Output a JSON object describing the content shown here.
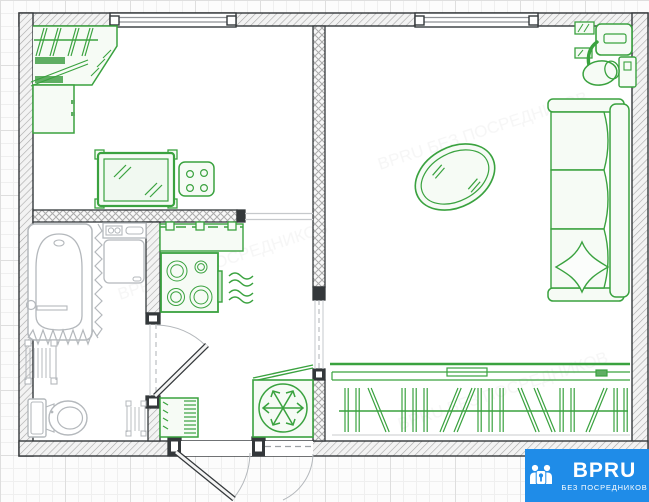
{
  "watermark": {
    "brand": "BPRU",
    "tagline": "БЕЗ ПОСРЕДНИКОВ",
    "ghost_text": "BPRU БЕЗ ПОСРЕДНИКОВ"
  },
  "colors": {
    "furniture_green": "#3aa23f",
    "furniture_fill": "#f6fbf5",
    "fixture_gray": "#b4b8bc",
    "wall_dark": "#34383b",
    "logo_blue": "#1f8ce8"
  },
  "floor_plan": {
    "rooms": [
      {
        "name": "bedroom",
        "position": "top-left",
        "furniture": [
          "corner-wardrobe-with-hangers",
          "shelves",
          "cabinet",
          "mirror-table",
          "four-burner-hob"
        ]
      },
      {
        "name": "kitchen-hallway",
        "position": "bottom-middle",
        "furniture": [
          "kitchen-counter",
          "stove-four-burners",
          "steam-vent",
          "refrigerator-snowflake",
          "shoe-cabinet"
        ]
      },
      {
        "name": "bathroom",
        "position": "bottom-left",
        "furniture": [
          "bathtub",
          "shower-curtain",
          "washing-machine",
          "radiator",
          "towel-ladder",
          "toilet",
          "rack"
        ]
      },
      {
        "name": "living-room",
        "position": "right",
        "furniture": [
          "desk-with-office-chair",
          "oval-coffee-table",
          "sofa-three-seat-with-pillow",
          "built-in-wardrobe-with-hangers"
        ]
      }
    ],
    "openings": [
      "window-top-left",
      "window-top-right",
      "entrance-door-bottom",
      "bathroom-door",
      "kitchen-living-room-opening",
      "bedroom-kitchen-opening"
    ]
  }
}
